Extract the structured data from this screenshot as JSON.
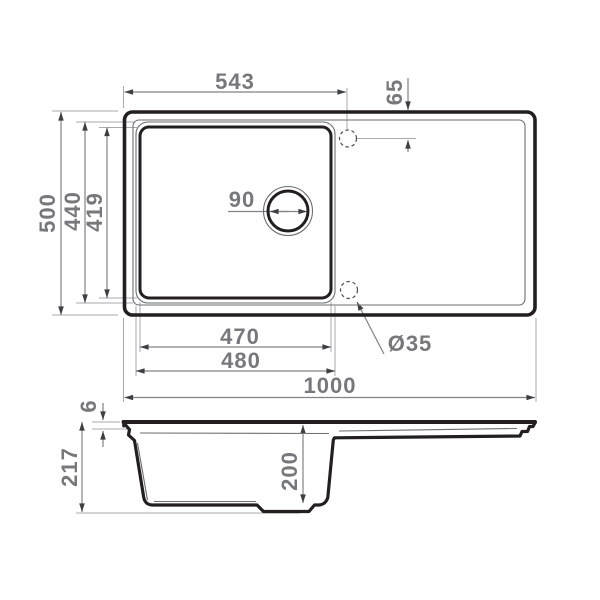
{
  "drawing": {
    "type": "technical-dimension-drawing",
    "subject": "kitchen sink with bowl, drain and drainboard",
    "views": [
      "top-view-plan",
      "side-view-section"
    ],
    "units": "mm"
  },
  "dims": {
    "tap_center_from_left": "543",
    "tap_center_from_top_edge": "65",
    "overall_width": "500",
    "bowl_outer_width": "440",
    "bowl_inner_width": "419",
    "drain_diameter": "90",
    "bowl_inner_length": "470",
    "bowl_outer_length": "480",
    "overall_length": "1000",
    "tap_hole_diameter": "Ø35",
    "rim_thickness": "6",
    "overall_depth": "217",
    "bowl_depth": "200"
  },
  "colors": {
    "background": "#ffffff",
    "outline": "#231f20",
    "dimension_text": "#77787b",
    "dimension_line": "#808285",
    "extension_line": "#a8aaad",
    "arrowhead": "#3e3f41"
  }
}
